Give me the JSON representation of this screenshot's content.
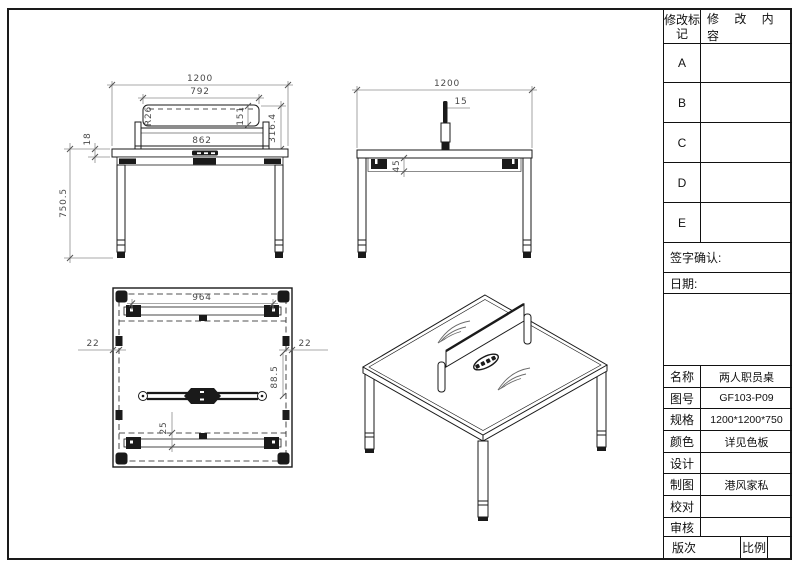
{
  "title_block": {
    "revision_mark_header": "修改标记",
    "revision_content_header": "修 改 内 容",
    "revision_rows": [
      "A",
      "B",
      "C",
      "D",
      "E"
    ],
    "signature_label": "签字确认:",
    "date_label": "日期:",
    "fields": [
      {
        "label": "名称",
        "value": "两人职员桌"
      },
      {
        "label": "图号",
        "value": "GF103-P09"
      },
      {
        "label": "规格",
        "value": "1200*1200*750"
      },
      {
        "label": "颜色",
        "value": "详见色板"
      },
      {
        "label": "设计",
        "value": ""
      },
      {
        "label": "制图",
        "value": "港风家私"
      },
      {
        "label": "校对",
        "value": ""
      },
      {
        "label": "审核",
        "value": ""
      }
    ],
    "version_label": "版次",
    "scale_label": "比例"
  },
  "views": {
    "front": {
      "dims": {
        "overall_width": "1200",
        "screen_width": "792",
        "corner_radius": "R26",
        "screen_height": "151",
        "screen_to_desktop": "316.4",
        "rail_width": "862",
        "top_thickness": "18",
        "desk_height": "750.5"
      }
    },
    "side": {
      "dims": {
        "overall_depth": "1200",
        "screen_thickness": "15",
        "apron_height": "45"
      }
    },
    "plan": {
      "dims": {
        "beam_span": "964",
        "left_edge_inset": "22",
        "right_edge_inset": "22",
        "bar_offset": "88.5",
        "beam_inset": "25"
      }
    }
  }
}
